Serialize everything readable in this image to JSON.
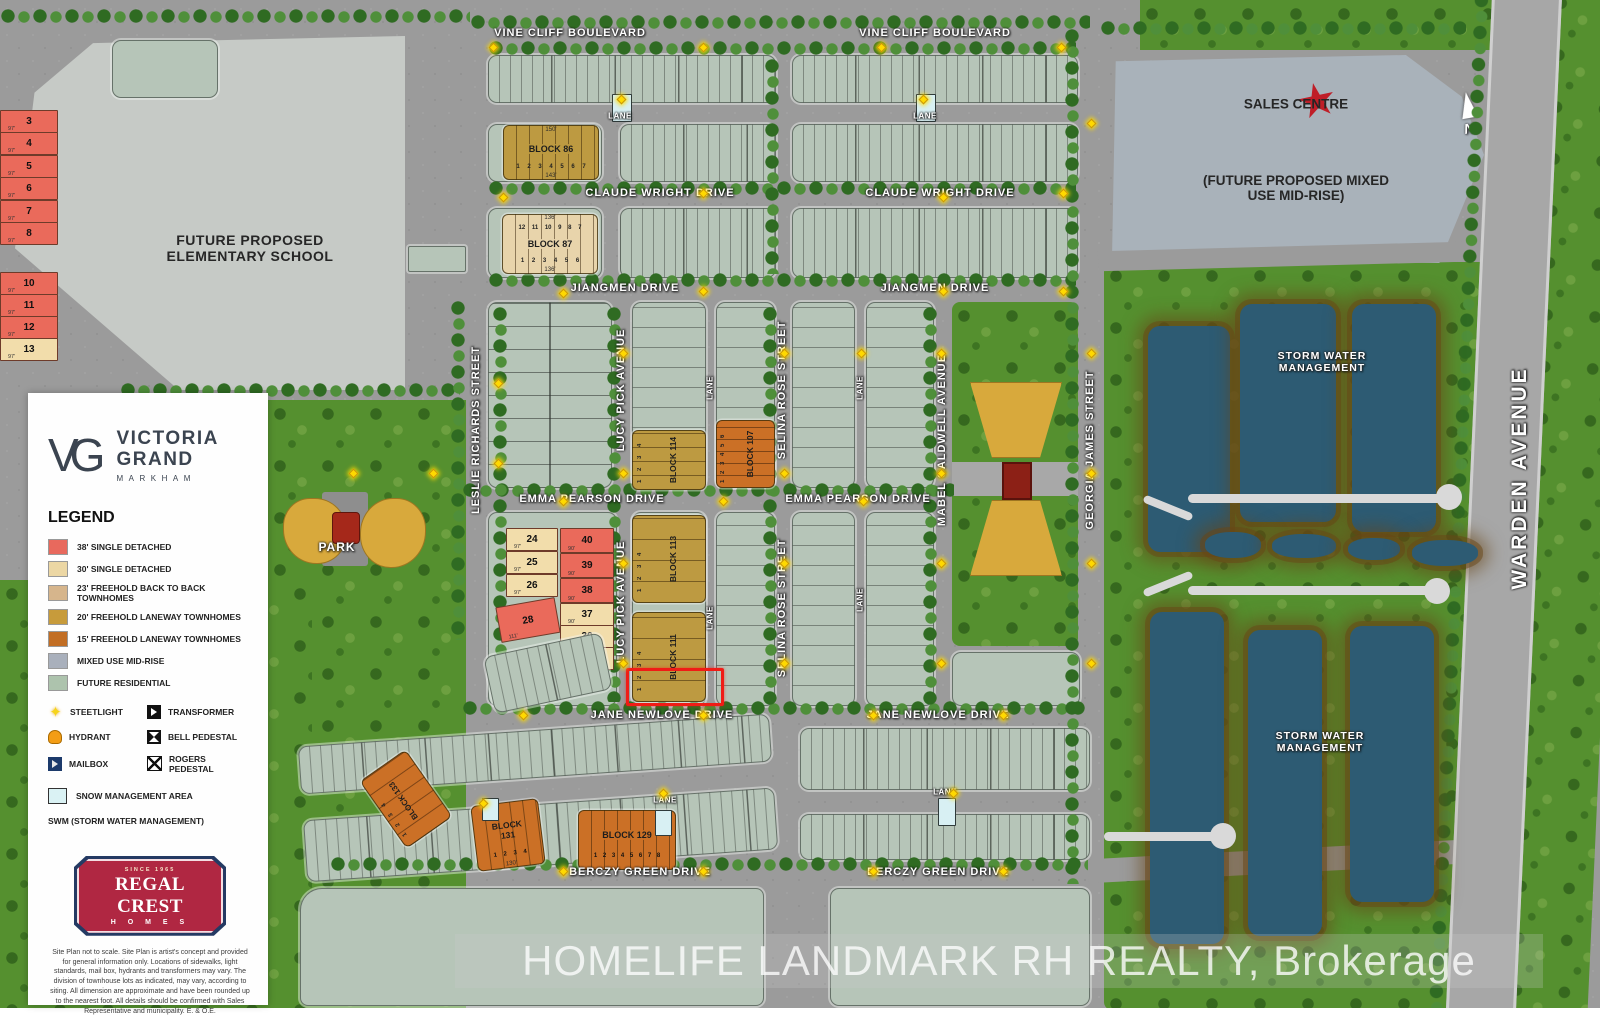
{
  "branding": {
    "monogram": "VG",
    "name1": "VICTORIA",
    "name2": "GRAND",
    "city": "MARKHAM"
  },
  "legend": {
    "title": "LEGEND",
    "items": [
      {
        "label": "38' SINGLE DETACHED",
        "color": "#e8695d"
      },
      {
        "label": "30' SINGLE DETACHED",
        "color": "#ecd7a4"
      },
      {
        "label": "23' FREEHOLD BACK TO BACK TOWNHOMES",
        "color": "#d6b58c"
      },
      {
        "label": "20' FREEHOLD LANEWAY TOWNHOMES",
        "color": "#c79b3b"
      },
      {
        "label": "15' FREEHOLD LANEWAY TOWNHOMES",
        "color": "#c26e24"
      },
      {
        "label": "MIXED USE MID-RISE",
        "color": "#a9b0bc"
      },
      {
        "label": "FUTURE RESIDENTIAL",
        "color": "#adc3ad"
      }
    ],
    "symbols": {
      "steetlight": "STEETLIGHT",
      "transformer": "TRANSFORMER",
      "hydrant": "HYDRANT",
      "bell": "BELL PEDESTAL",
      "mailbox": "MAILBOX",
      "rogers": "ROGERS PEDESTAL",
      "snow": "SNOW MANAGEMENT AREA"
    },
    "swm_note": "SWM (STORM WATER MANAGEMENT)"
  },
  "builder": {
    "since": "SINCE 1965",
    "name": "REGAL CREST",
    "homes": "H O M E S",
    "disclaimer": "Site Plan not to scale. Site Plan is artist's concept and provided for general information only. Locations of sidewalks, light standards, mail box, hydrants and transformers may vary. The division of townhouse lots as indicated, may vary, according to siting. All dimension are approximate and have been rounded up to the nearest foot. All details should be confirmed with Sales Representative and municipality. E. & O.E."
  },
  "watermark": "HOMELIFE LANDMARK RH REALTY, Brokerage",
  "streets": {
    "vine_cliff": "VINE CLIFF BOULEVARD",
    "claude_wright": "CLAUDE WRIGHT DRIVE",
    "jiangmen": "JIANGMEN DRIVE",
    "emma_pearson": "EMMA PEARSON DRIVE",
    "jane_newlove": "JANE NEWLOVE DRIVE",
    "berczy_green": "BERCZY GREEN DRIVE",
    "leslie_richards": "LESLIE RICHARDS STREET",
    "lucy_pick": "LUCY PICK AVENUE",
    "selina_rose": "SELINA ROSE STREET",
    "mabel_caldwell": "MABEL CALDWELL AVENUE",
    "georgia_james": "GEORGIA JAMES STREET",
    "warden": "WARDEN AVENUE",
    "lane": "LANE"
  },
  "areas": {
    "school": "FUTURE PROPOSED ELEMENTARY SCHOOL",
    "sales_centre": "SALES CENTRE",
    "mixed_use": "(FUTURE PROPOSED MIXED USE MID-RISE)",
    "swm": "STORM WATER MANAGEMENT",
    "park": "PARK",
    "north": "N"
  },
  "blocks": {
    "b86": {
      "label": "BLOCK 86",
      "lots": "1 2 3 4 5 6 7",
      "dim_top": "150'",
      "dim_bottom": "143'"
    },
    "b87": {
      "label": "BLOCK 87",
      "row_top": "12 11 10 9 8 7",
      "row_bottom": "1 2 3 4 5 6",
      "dim_top": "136'",
      "dim_bottom": "136'"
    },
    "b107": {
      "label": "BLOCK 107",
      "lots": "1 2 3 4 5 6"
    },
    "b114": {
      "label": "BLOCK 114",
      "lots": "1 2 3 4"
    },
    "b113": {
      "label": "BLOCK 113",
      "lots": "1 2 3 4"
    },
    "b111": {
      "label": "BLOCK 111",
      "lots": "1 2 3 4"
    },
    "b129": {
      "label": "BLOCK 129",
      "lots": "1 2 3 4 5 6 7 8"
    },
    "b131": {
      "label": "BLOCK 131",
      "lots": "1 2 3 4",
      "dim": "130'"
    },
    "b133": {
      "label": "BLOCK 133",
      "lots": "1 2 3 4"
    }
  },
  "lots": {
    "school": [
      {
        "n": "3",
        "d": "97'"
      },
      {
        "n": "4",
        "d": "97'"
      },
      {
        "n": "5",
        "d": "97'"
      },
      {
        "n": "6",
        "d": "97'"
      },
      {
        "n": "7",
        "d": "97'"
      },
      {
        "n": "8",
        "d": "97'"
      },
      {
        "n": "10",
        "d": "97'"
      },
      {
        "n": "11",
        "d": "97'"
      },
      {
        "n": "12",
        "d": "97'"
      },
      {
        "n": "13",
        "d": "97'"
      }
    ],
    "mid": [
      {
        "n": "24",
        "d": "97'"
      },
      {
        "n": "25",
        "d": "97'"
      },
      {
        "n": "26",
        "d": "97'"
      },
      {
        "n": "40",
        "d": "90'"
      },
      {
        "n": "39",
        "d": "90'"
      },
      {
        "n": "38",
        "d": "90'"
      },
      {
        "n": "37",
        "d": "90'"
      },
      {
        "n": "36",
        "d": "90'"
      },
      {
        "n": "35",
        "d": "90'"
      },
      {
        "n": "28",
        "d": "111'"
      }
    ]
  },
  "decor": {
    "streetlights": [
      [
        490,
        44
      ],
      [
        700,
        44
      ],
      [
        878,
        44
      ],
      [
        1058,
        44
      ],
      [
        618,
        96
      ],
      [
        920,
        96
      ],
      [
        500,
        194
      ],
      [
        700,
        190
      ],
      [
        940,
        194
      ],
      [
        1060,
        190
      ],
      [
        560,
        290
      ],
      [
        700,
        288
      ],
      [
        940,
        288
      ],
      [
        1060,
        288
      ],
      [
        495,
        380
      ],
      [
        495,
        460
      ],
      [
        620,
        350
      ],
      [
        620,
        470
      ],
      [
        781,
        350
      ],
      [
        781,
        470
      ],
      [
        858,
        350
      ],
      [
        938,
        350
      ],
      [
        938,
        470
      ],
      [
        1088,
        350
      ],
      [
        1088,
        470
      ],
      [
        560,
        498
      ],
      [
        720,
        498
      ],
      [
        860,
        498
      ],
      [
        620,
        560
      ],
      [
        620,
        660
      ],
      [
        781,
        560
      ],
      [
        781,
        660
      ],
      [
        938,
        560
      ],
      [
        938,
        660
      ],
      [
        520,
        712
      ],
      [
        700,
        712
      ],
      [
        870,
        712
      ],
      [
        1000,
        712
      ],
      [
        660,
        790
      ],
      [
        950,
        790
      ],
      [
        480,
        800
      ],
      [
        560,
        868
      ],
      [
        700,
        868
      ],
      [
        870,
        868
      ],
      [
        1000,
        868
      ],
      [
        1088,
        560
      ],
      [
        1088,
        660
      ],
      [
        350,
        470
      ],
      [
        430,
        470
      ],
      [
        1088,
        120
      ]
    ]
  }
}
